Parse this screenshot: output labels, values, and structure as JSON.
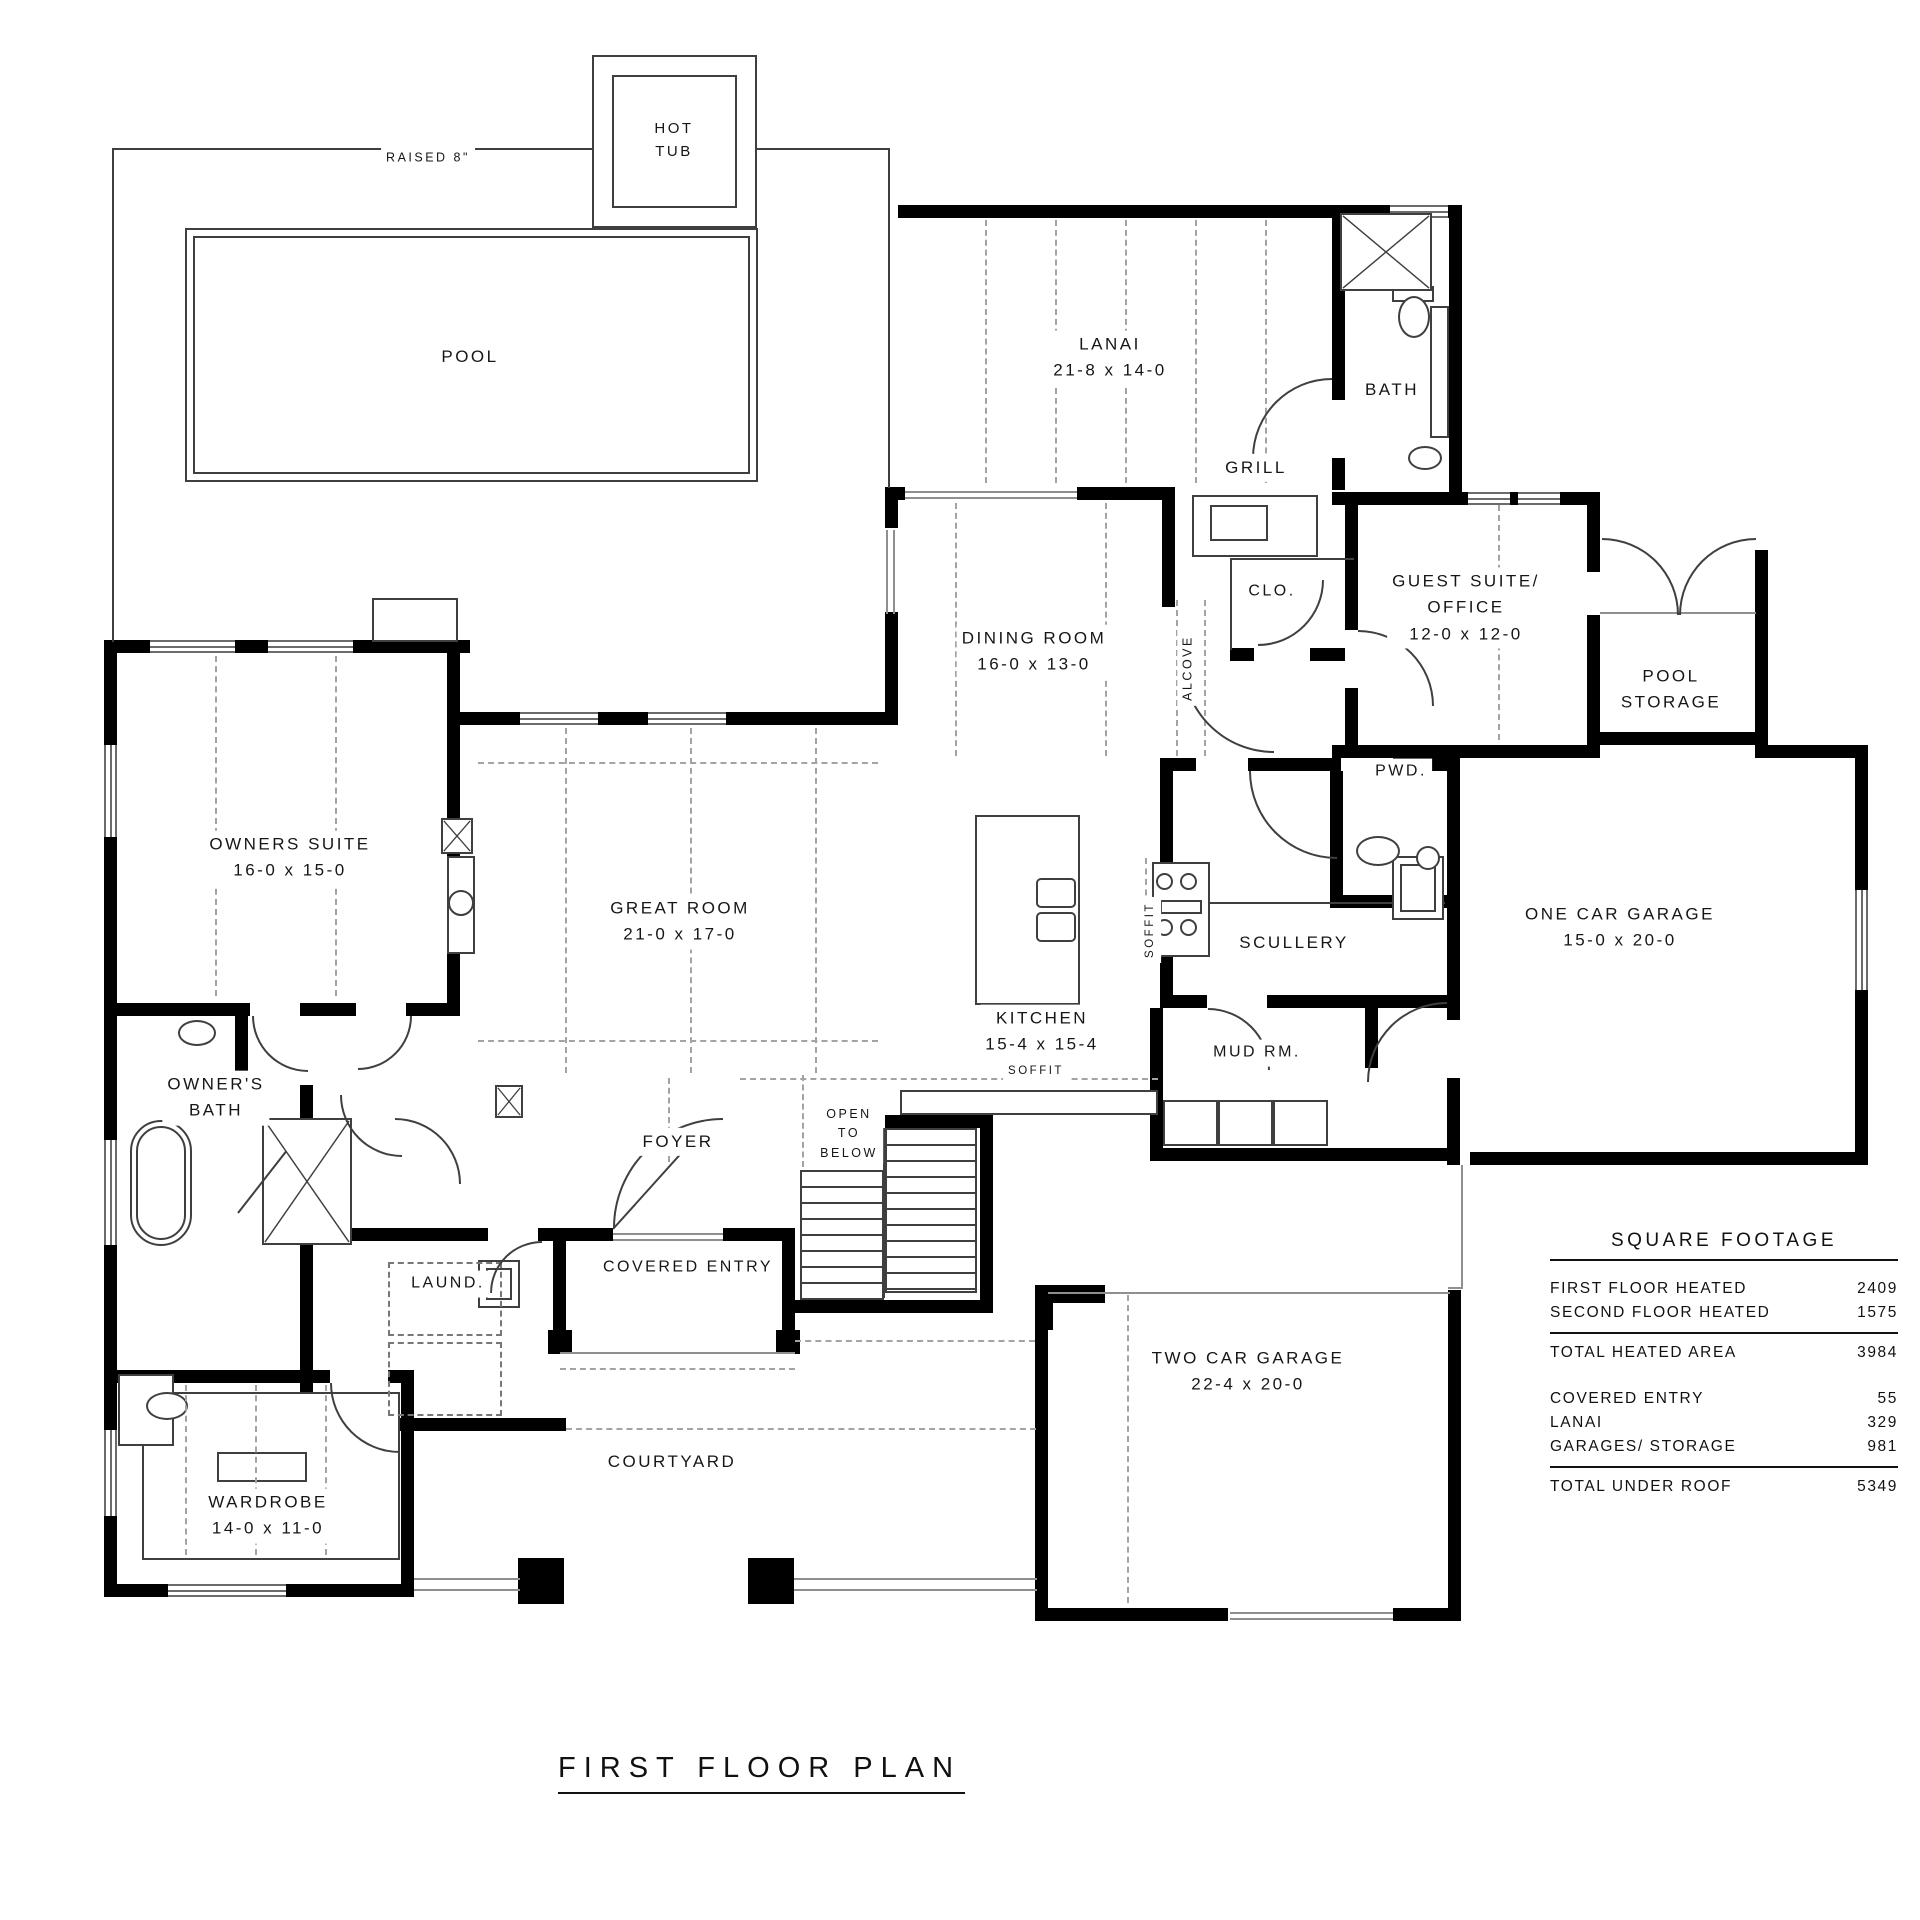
{
  "plan": {
    "title": "FIRST FLOOR PLAN"
  },
  "labels": [
    {
      "id": "pool",
      "lines": [
        "POOL"
      ]
    },
    {
      "id": "raised",
      "lines": [
        "RAISED 8\""
      ]
    },
    {
      "id": "hot_tub",
      "lines": [
        "HOT",
        "TUB"
      ]
    },
    {
      "id": "lanai",
      "lines": [
        "LANAI",
        "21-8 x 14-0"
      ]
    },
    {
      "id": "bath",
      "lines": [
        "BATH"
      ]
    },
    {
      "id": "grill",
      "lines": [
        "GRILL"
      ]
    },
    {
      "id": "dining",
      "lines": [
        "DINING ROOM",
        "16-0 x 13-0"
      ]
    },
    {
      "id": "alcove",
      "lines": [
        "ALCOVE"
      ]
    },
    {
      "id": "clo",
      "lines": [
        "CLO."
      ]
    },
    {
      "id": "guest",
      "lines": [
        "GUEST SUITE/",
        "OFFICE",
        "12-0 x 12-0"
      ]
    },
    {
      "id": "pool_storage",
      "lines": [
        "POOL",
        "STORAGE"
      ]
    },
    {
      "id": "pwd",
      "lines": [
        "PWD."
      ]
    },
    {
      "id": "owners_suite",
      "lines": [
        "OWNERS SUITE",
        "16-0 x 15-0"
      ]
    },
    {
      "id": "great_room",
      "lines": [
        "GREAT ROOM",
        "21-0 x 17-0"
      ]
    },
    {
      "id": "kitchen",
      "lines": [
        "KITCHEN",
        "15-4 x 15-4"
      ]
    },
    {
      "id": "soffit_v",
      "lines": [
        "SOFFIT"
      ]
    },
    {
      "id": "soffit_h",
      "lines": [
        "SOFFIT"
      ]
    },
    {
      "id": "scullery",
      "lines": [
        "SCULLERY"
      ]
    },
    {
      "id": "mud_rm",
      "lines": [
        "MUD RM."
      ]
    },
    {
      "id": "one_car",
      "lines": [
        "ONE CAR GARAGE",
        "15-0 x 20-0"
      ]
    },
    {
      "id": "owners_bath",
      "lines": [
        "OWNER'S",
        "BATH"
      ]
    },
    {
      "id": "foyer",
      "lines": [
        "FOYER"
      ]
    },
    {
      "id": "open_below",
      "lines": [
        "OPEN",
        "TO",
        "BELOW"
      ]
    },
    {
      "id": "laund",
      "lines": [
        "LAUND."
      ]
    },
    {
      "id": "covered_entry",
      "lines": [
        "COVERED ENTRY"
      ]
    },
    {
      "id": "two_car",
      "lines": [
        "TWO CAR GARAGE",
        "22-4 x 20-0"
      ]
    },
    {
      "id": "courtyard",
      "lines": [
        "COURTYARD"
      ]
    },
    {
      "id": "wardrobe",
      "lines": [
        "WARDROBE",
        "14-0 x 11-0"
      ]
    }
  ],
  "square_footage": {
    "title": "SQUARE FOOTAGE",
    "rows": [
      {
        "label": "FIRST FLOOR HEATED",
        "value": "2409"
      },
      {
        "label": "SECOND FLOOR HEATED",
        "value": "1575"
      }
    ],
    "total_heated": {
      "label": "TOTAL HEATED AREA",
      "value": "3984"
    },
    "extras": [
      {
        "label": "COVERED ENTRY",
        "value": "55"
      },
      {
        "label": "LANAI",
        "value": "329"
      },
      {
        "label": "GARAGES/ STORAGE",
        "value": "981"
      }
    ],
    "total_roof": {
      "label": "TOTAL UNDER ROOF",
      "value": "5349"
    }
  },
  "colors": {
    "wall": "#000000",
    "thin_line": "#3f3f3f",
    "gray_line": "#8f8f8f",
    "dash": "#a3a3a3",
    "text": "#161616",
    "background": "#ffffff"
  }
}
